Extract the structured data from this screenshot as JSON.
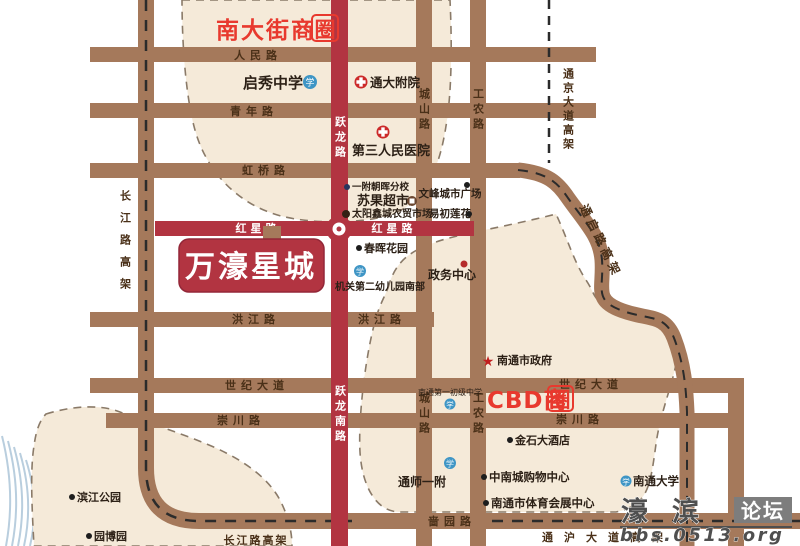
{
  "project": {
    "name": "万濠星城"
  },
  "business_circles": {
    "nandajie": {
      "text": "南大街商",
      "boxed": "圈"
    },
    "cbd": {
      "text": "CBD商",
      "boxed": "圈"
    }
  },
  "roads": {
    "renmin": "人民路",
    "qingnian": "青年路",
    "hongqiao": "虹桥路",
    "hongxing": "红星路",
    "hongjiang": "洪江路",
    "shiji": "世纪大道",
    "chongchuan": "崇川路",
    "seyuan": "啬园路",
    "yuelong": "跃龙路",
    "yuelong_south": "跃龙南路",
    "chengshan": "城山路",
    "gongnong": "工农路",
    "changjiang_viaduct": "长江路高架",
    "tongjing_viaduct": "通京大道高架",
    "tongqi_viaduct": "通启路高架",
    "tonghu_viaduct": "通沪大道高架"
  },
  "landmarks": {
    "qixiu": "启秀中学",
    "tongda_hospital": "通大附院",
    "third_hospital": "第三人民医院",
    "yifu_chaohui": "一附朝晖分校",
    "suguo": "苏果超市",
    "taiyang_market": "太阳鑫城农贸市场",
    "wenfeng_plaza": "文峰城市广场",
    "yichu_lianhua": "易初莲花",
    "chunhui_garden": "春晖花园",
    "zhengwu_center": "政务中心",
    "jiguan_kindergarten": "机关第二幼儿园南部",
    "city_gov": "南通市政府",
    "jinshi_hotel": "金石大酒店",
    "no1_junior_middle": "南通第一初级中学",
    "tongshi_yifu": "通师一附",
    "zhongnan_mall": "中南城购物中心",
    "sports_center": "南通市体育会展中心",
    "nantong_univ": "南通大学",
    "binjiang_park": "滨江公园",
    "yuanbo_garden": "园博园"
  },
  "icons": {
    "school_char": "学",
    "star_char": "★"
  },
  "watermark": {
    "name": "濠滨",
    "forum": "论坛",
    "url": "bbs.0513.org"
  },
  "colors": {
    "road": "#a5795b",
    "red_road": "#b23441",
    "beige_zone": "#f5ead9",
    "accent_red": "#e8392e",
    "label_brown": "#4a3018"
  }
}
